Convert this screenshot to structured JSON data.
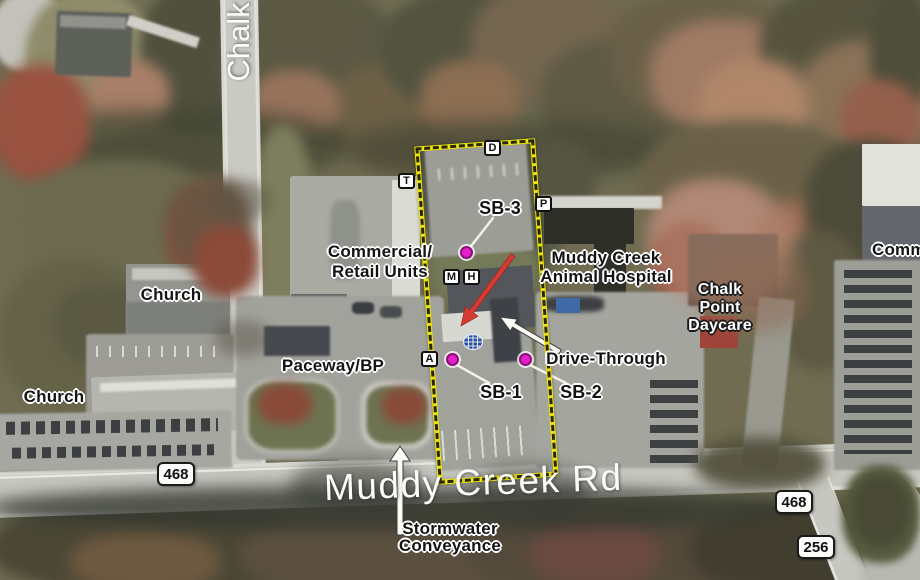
{
  "road_labels": {
    "chalk": "Chalk",
    "muddy_creek": "Muddy Creek Rd"
  },
  "shields": {
    "left_468": "468",
    "right_468": "468",
    "route_256": "256"
  },
  "site_markers": {
    "d": "D",
    "t": "T",
    "p": "P",
    "m": "M",
    "h": "H",
    "a": "A"
  },
  "boring_labels": {
    "sb1": "SB-1",
    "sb2": "SB-2",
    "sb3": "SB-3"
  },
  "place_labels": {
    "church_upper": "Church",
    "church_lower": "Church",
    "commercial_retail_line1": "Commercial/",
    "commercial_retail_line2": "Retail Units",
    "animal_hospital_line1": "Muddy Creek",
    "animal_hospital_line2": "Animal Hospital",
    "daycare_line1": "Chalk",
    "daycare_line2": "Point",
    "daycare_line3": "Daycare",
    "commercial_right": "Comm",
    "paceway_bp": "Paceway/BP",
    "drive_through": "Drive-Through",
    "stormwater_line1": "Stormwater",
    "stormwater_line2": "Conveyance"
  },
  "colors": {
    "site_boundary": "#efe40a",
    "boring_dot": "#e51fca",
    "boring_dot_ring": "#8c0f78",
    "highlight_arrow": "#d33b35",
    "callout_arrow_fill": "#fbfbf5",
    "utility_symbol": "#2a4f9e",
    "shield_background": "#fcfcfa",
    "label_dark_text": "#141414",
    "label_light_text": "#ffffff"
  }
}
